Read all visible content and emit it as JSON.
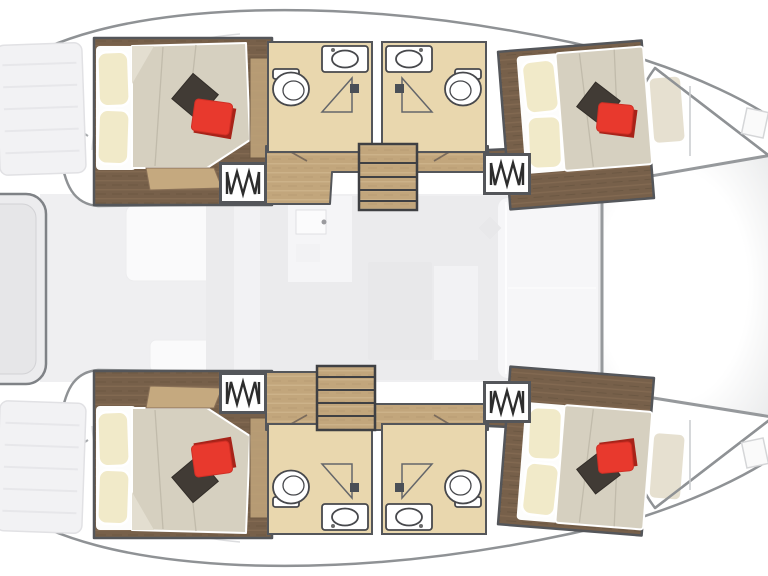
{
  "diagram": {
    "type": "catamaran-floor-plan",
    "label": "catamaran-interior-layout-plan",
    "orientation": "bow-right",
    "features": {
      "hulls": [
        "port-hull",
        "starboard-hull"
      ],
      "cabins": [
        {
          "id": "aft-port-cabin",
          "icon": "double-bed"
        },
        {
          "id": "forward-port-cabin",
          "icon": "double-bed"
        },
        {
          "id": "aft-starboard-cabin",
          "icon": "double-bed"
        },
        {
          "id": "forward-starboard-cabin",
          "icon": "double-bed"
        }
      ],
      "bathrooms": [
        {
          "id": "port-aft-head",
          "icons": [
            "toilet",
            "sink",
            "shower"
          ]
        },
        {
          "id": "port-forward-head",
          "icons": [
            "toilet",
            "sink",
            "shower"
          ]
        },
        {
          "id": "starboard-aft-head",
          "icons": [
            "toilet",
            "sink",
            "shower"
          ]
        },
        {
          "id": "starboard-forward-head",
          "icons": [
            "toilet",
            "sink",
            "shower"
          ]
        }
      ],
      "saloon": {
        "icons": [
          "galley-counter",
          "sink",
          "table",
          "forward-seating"
        ]
      },
      "cockpit": {
        "icons": [
          "bench-seating",
          "stern-platform",
          "cockpit-table"
        ]
      },
      "foredeck": {
        "icons": [
          "trampoline",
          "bow-locker"
        ]
      },
      "companionway_hatches": 4,
      "staircases": 2,
      "symbols": {
        "zigzag-box": "companionway-steps",
        "v-lines": "door-swing",
        "triangle": "shower-pan",
        "double-ellipse": "toilet"
      }
    }
  },
  "colors": {
    "hull_outline": "#8f9295",
    "hull_fill": "#ffffff",
    "room_border": "#54565a",
    "wood_dark": "#77604a",
    "wood_dark_streak": "#8b7157",
    "wood_dark_shadow": "#62503c",
    "wood_light": "#c2a67c",
    "wood_light_streak": "#d1b88f",
    "bath_floor": "#e9d7ae",
    "fixture_outline": "#47484c",
    "mattress": "#d6d0c0",
    "mattress_crease": "#c1bbab",
    "sheet_white": "#fdfdfc",
    "pillow_cream": "#f1eac9",
    "pillow_dark": "#413b35",
    "pillow_red": "#e8392d",
    "pillow_red_shadow": "#a82319",
    "bench_tan": "#c5a97f",
    "saloon_floor": "#ebebed",
    "cockpit_floor": "#efeff1",
    "furniture_faint": "#f6f6f8",
    "furniture_mid": "#e8e8ea",
    "tramp_edge": "#96999c",
    "stairs_frame": "#3f4043"
  }
}
